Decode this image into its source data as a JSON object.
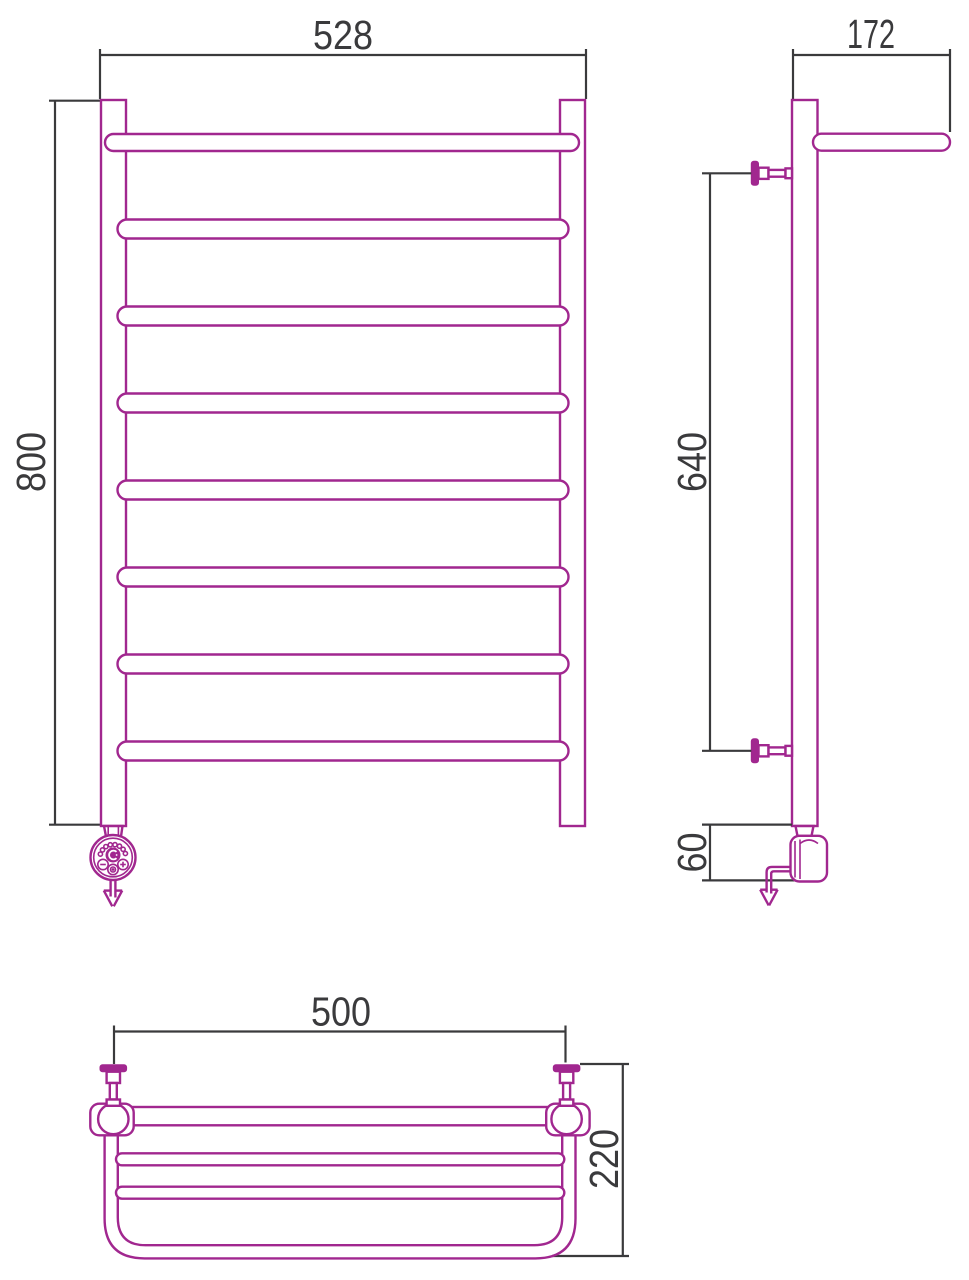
{
  "drawing": {
    "front_view": {
      "width_label": "528",
      "height_label": "800"
    },
    "side_view": {
      "depth_label": "172",
      "bracket_spacing_label": "640",
      "heater_offset_label": "60"
    },
    "plan_view": {
      "width_label": "500",
      "depth_label": "220"
    },
    "colors": {
      "line": "#a1278f",
      "dimension": "#3a3a3c",
      "background": "#ffffff"
    }
  }
}
